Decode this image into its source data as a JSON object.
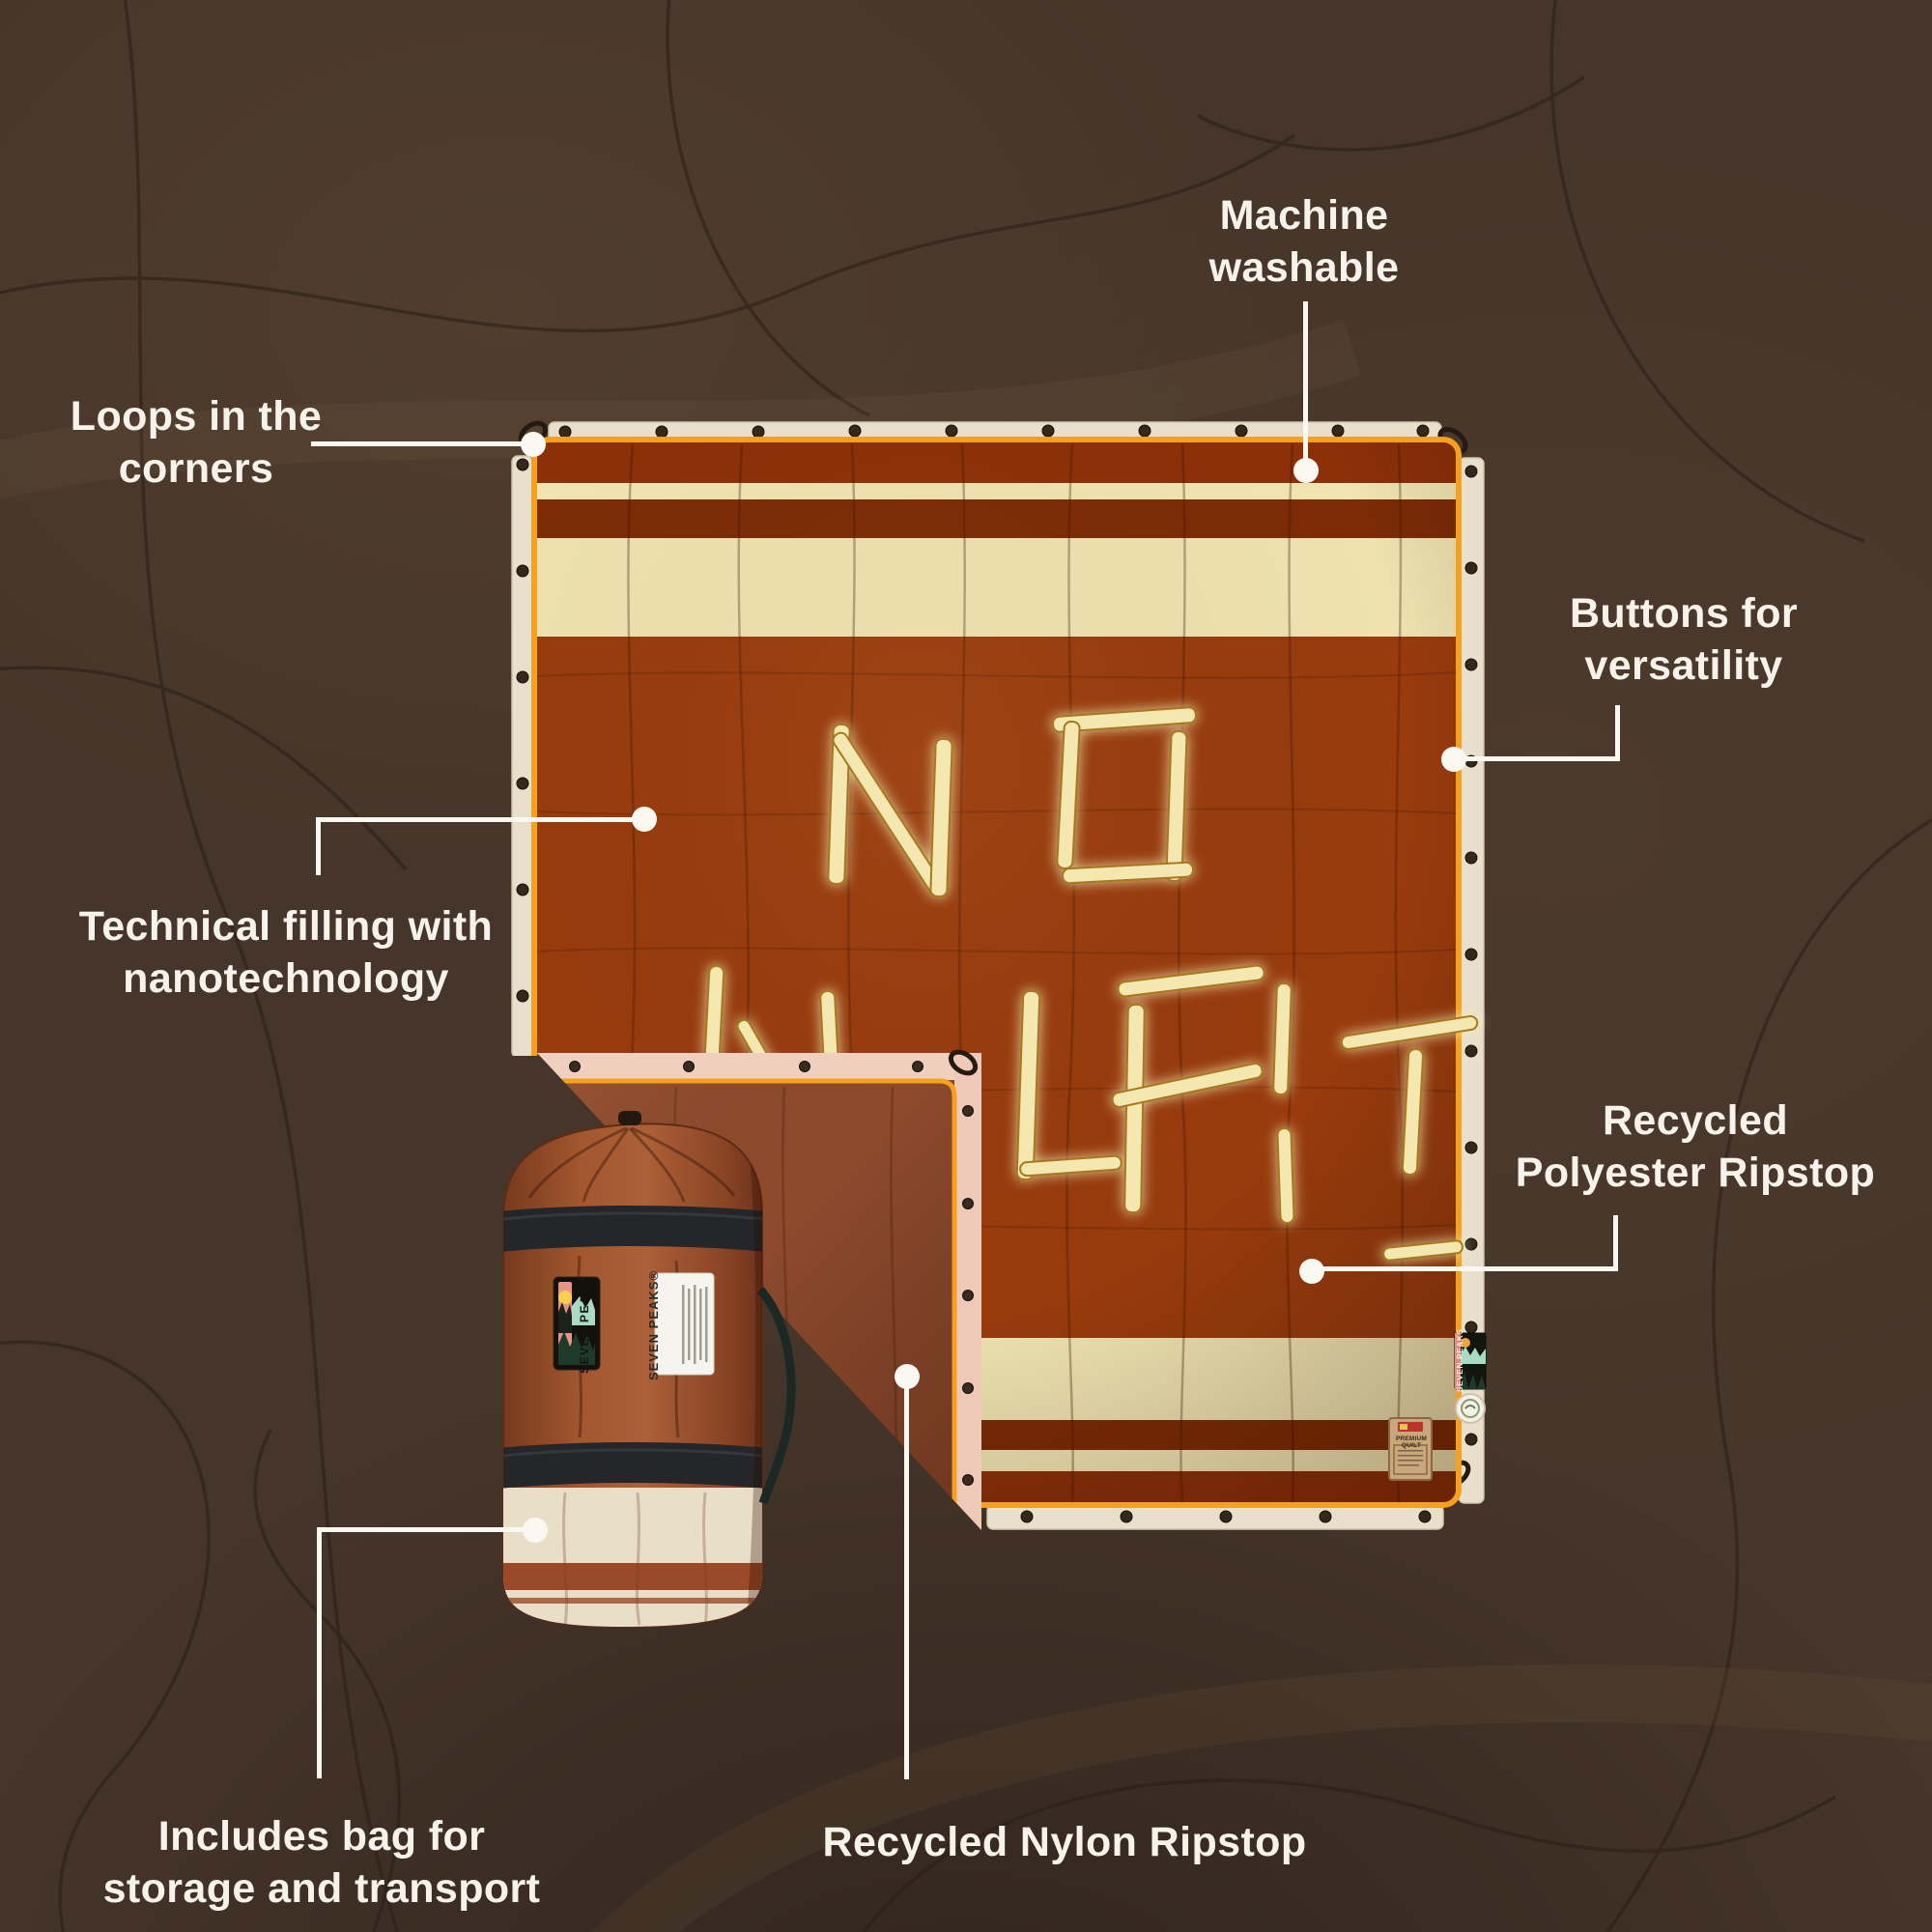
{
  "callouts": {
    "machine_washable": {
      "lines": [
        "Machine",
        "washable"
      ]
    },
    "loops_in_corners": {
      "lines": [
        "Loops in the",
        "corners"
      ]
    },
    "buttons_versatility": {
      "lines": [
        "Buttons for",
        "versatility"
      ]
    },
    "technical_filling": {
      "lines": [
        "Technical filling with",
        "nanotechnology"
      ]
    },
    "recycled_polyester": {
      "lines": [
        "Recycled",
        "Polyester Ripstop"
      ]
    },
    "includes_bag": {
      "lines": [
        "Includes bag for",
        "storage and transport"
      ]
    },
    "recycled_nylon": {
      "lines": [
        "Recycled Nylon Ripstop"
      ]
    }
  },
  "product": {
    "brand_patch": "SEVEN PEAKS",
    "bag_label_title": "SEVEN PEAKS®",
    "edge_label": "SEVEN PEAKS",
    "hang_tag": "PREMIUM QUILT",
    "stick_message": "NO WIFI"
  },
  "colors": {
    "background": "#46352A",
    "blanket_rust": "#983B0D",
    "blanket_dark_stripe": "#7C2B06",
    "blanket_cream": "#EFE2B0",
    "trim_orange": "#F5A01F",
    "flange_cream": "#E8E0CC",
    "fold_pink": "#F1CFBE",
    "underside_rust": "#8E4A2D",
    "bag_rust": "#9A5430",
    "strap_black": "#24262A",
    "callout_white": "#F8F4EA"
  }
}
